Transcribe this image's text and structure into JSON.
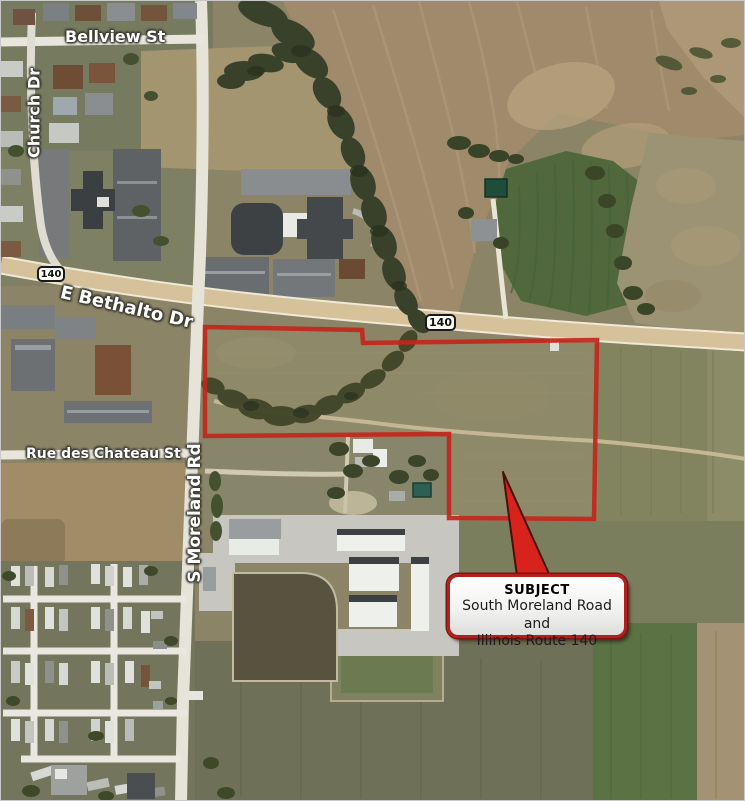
{
  "map": {
    "street_labels": [
      {
        "id": "bellview",
        "text": "Bellview St"
      },
      {
        "id": "church-dr",
        "text": "Church Dr"
      },
      {
        "id": "e-bethalto-dr",
        "text": "E Bethalto Dr"
      },
      {
        "id": "rue-des-chateau",
        "text": "Rue des Chateau St"
      },
      {
        "id": "s-moreland-rd",
        "text": "S Moreland Rd"
      }
    ],
    "route_shields": [
      {
        "label": "140"
      },
      {
        "label": "140"
      }
    ],
    "callout": {
      "title": "SUBJECT",
      "line1": "South Moreland Road and",
      "line2": "Illinois Route 140"
    },
    "colors": {
      "boundary": "#C2261B",
      "arrow": "#D8231C",
      "callout_border": "#B2201E",
      "shield_border": "#1A1A1A",
      "highway": "#D6C29A"
    }
  }
}
